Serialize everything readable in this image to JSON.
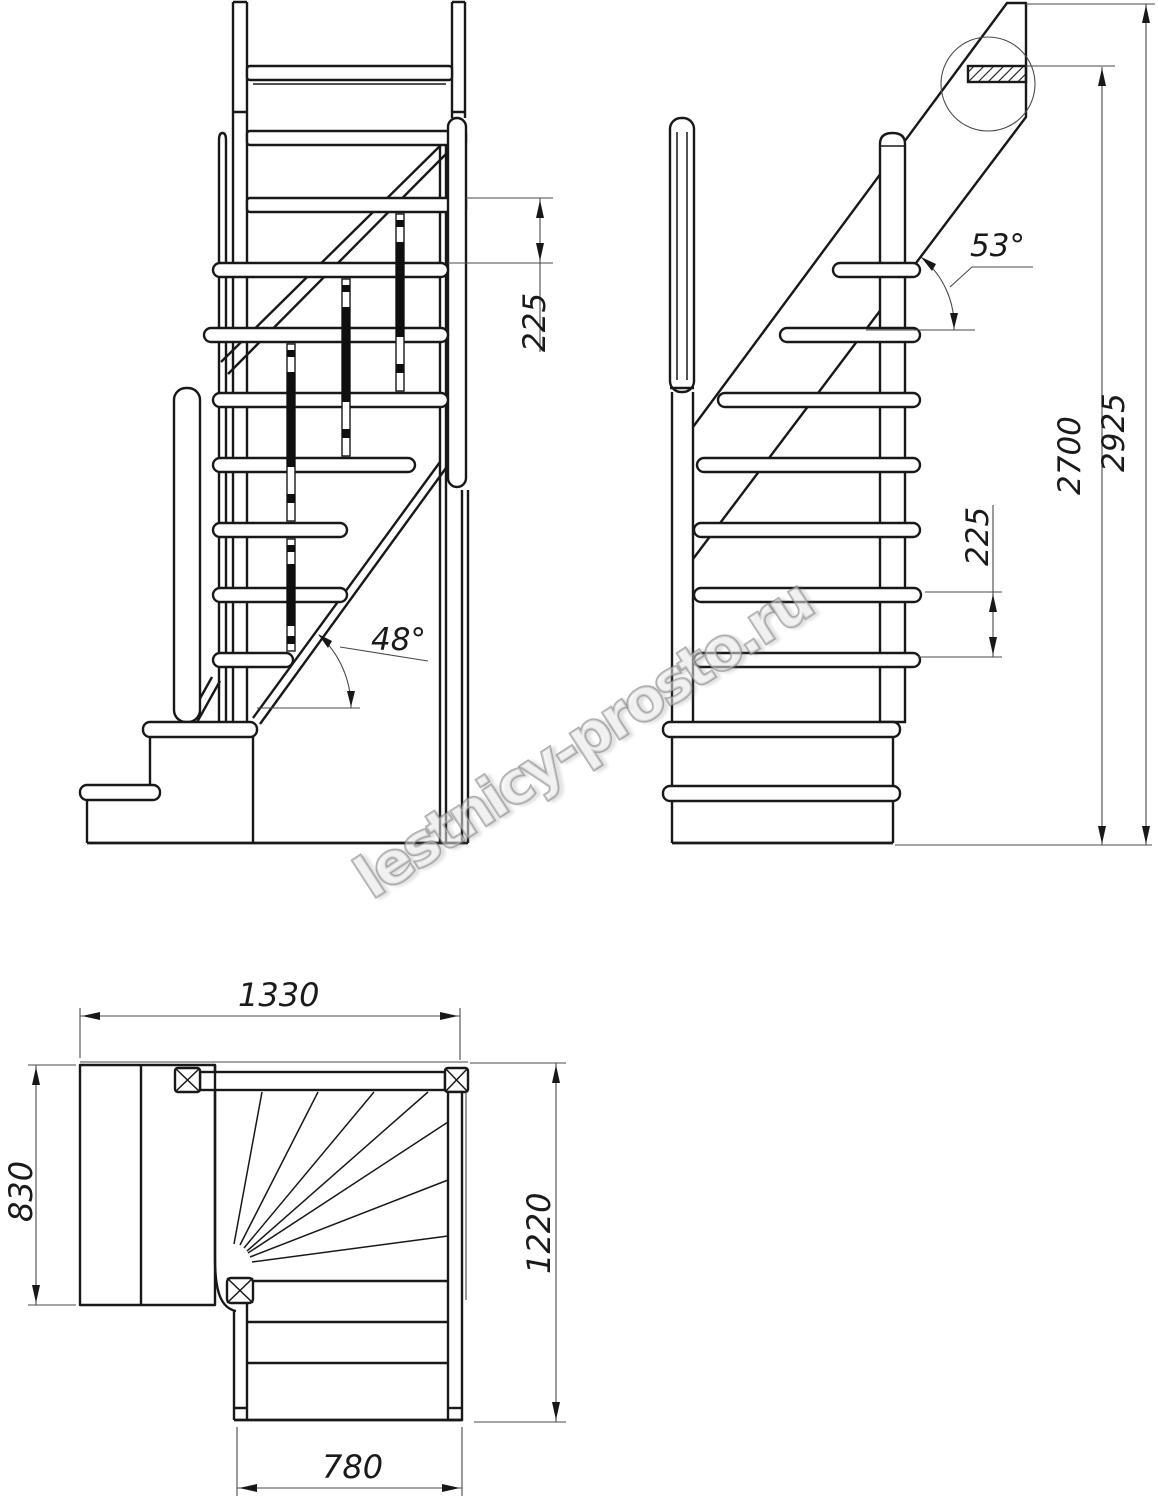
{
  "drawing": {
    "watermark": "lestnicy-prosto.ru",
    "front": {
      "riser_spacing": "225",
      "stringer_angle": "48°"
    },
    "side": {
      "stringer_angle": "53°",
      "riser_spacing": "225",
      "clear_height": "2700",
      "total_height": "2925"
    },
    "plan": {
      "overall_width": "1330",
      "landing_depth": "830",
      "overall_depth": "1220",
      "flight_width": "780"
    }
  }
}
